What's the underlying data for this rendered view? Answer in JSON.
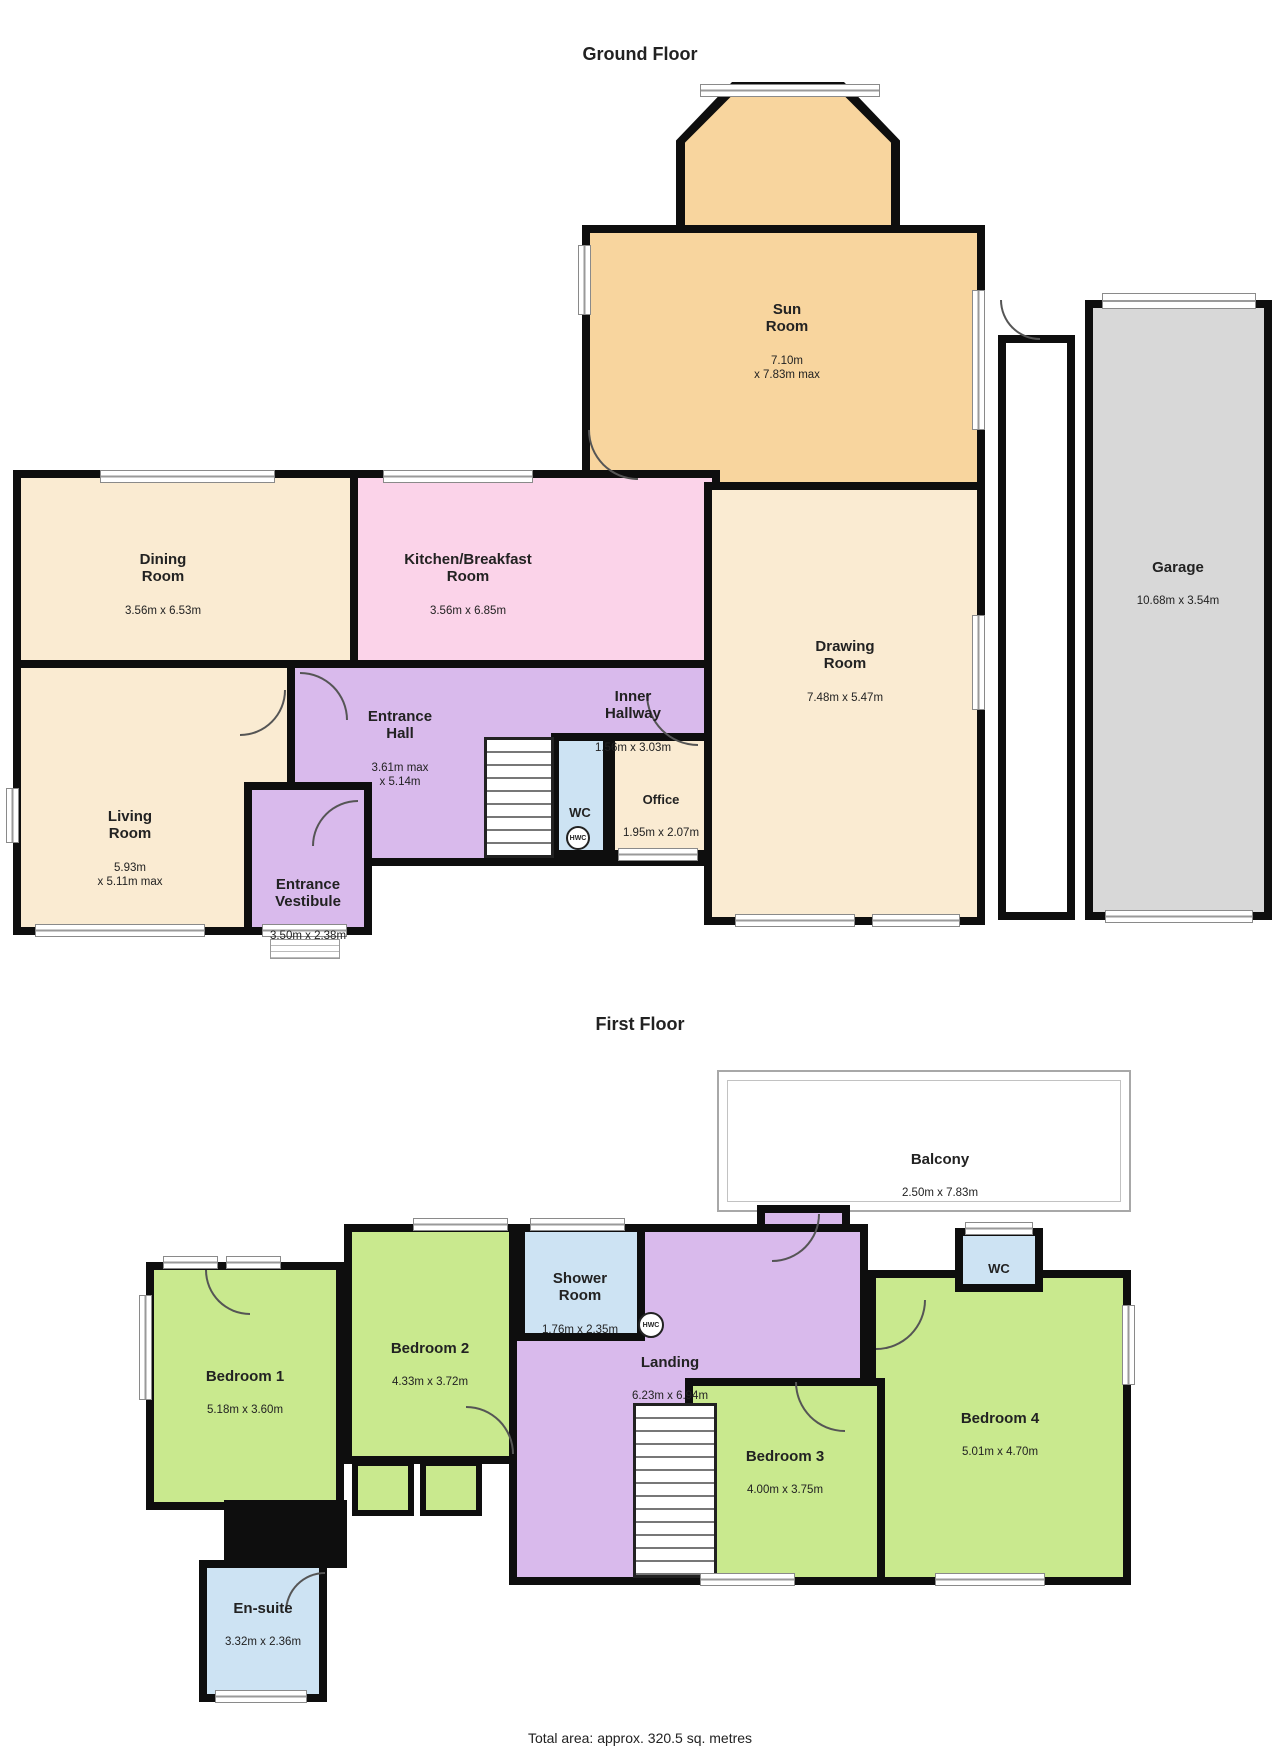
{
  "colors": {
    "cream": "#FAEBD2",
    "orange": "#F8D59E",
    "pink": "#FBD3E9",
    "purple": "#D9BAEC",
    "blue": "#CDE3F3",
    "green": "#C9E98E",
    "gray": "#D8D8D8",
    "wall": "#0E0E0E",
    "white": "#FFFFFF"
  },
  "titles": {
    "ground": "Ground Floor",
    "first": "First Floor"
  },
  "footer": {
    "total_area": "Total area: approx. 320.5 sq. metres"
  },
  "ground": {
    "sun": {
      "name": "Sun\nRoom",
      "dims": "7.10m\nx 7.83m max"
    },
    "dining": {
      "name": "Dining\nRoom",
      "dims": "3.56m x 6.53m"
    },
    "kitchen": {
      "name": "Kitchen/Breakfast\nRoom",
      "dims": "3.56m x 6.85m"
    },
    "drawing": {
      "name": "Drawing\nRoom",
      "dims": "7.48m x 5.47m"
    },
    "living": {
      "name": "Living\nRoom",
      "dims": "5.93m\nx 5.11m max"
    },
    "hall": {
      "name": "Entrance\nHall",
      "dims": "3.61m max\nx 5.14m"
    },
    "inner": {
      "name": "Inner\nHallway",
      "dims": "1.56m x 3.03m"
    },
    "wc": {
      "name": "WC"
    },
    "office": {
      "name": "Office",
      "dims": "1.95m x 2.07m"
    },
    "vestibule": {
      "name": "Entrance\nVestibule",
      "dims": "3.50m x 2.38m"
    },
    "garage": {
      "name": "Garage",
      "dims": "10.68m x 3.54m"
    },
    "hwc": "HWC"
  },
  "first": {
    "balcony": {
      "name": "Balcony",
      "dims": "2.50m x 7.83m"
    },
    "bedroom1": {
      "name": "Bedroom 1",
      "dims": "5.18m x 3.60m"
    },
    "bedroom2": {
      "name": "Bedroom 2",
      "dims": "4.33m x 3.72m"
    },
    "shower": {
      "name": "Shower\nRoom",
      "dims": "1.76m x 2.35m"
    },
    "landing": {
      "name": "Landing",
      "dims": "6.23m x 6.94m"
    },
    "bedroom3": {
      "name": "Bedroom 3",
      "dims": "4.00m x 3.75m"
    },
    "bedroom4": {
      "name": "Bedroom 4",
      "dims": "5.01m x 4.70m"
    },
    "wc": {
      "name": "WC"
    },
    "ensuite": {
      "name": "En-suite",
      "dims": "3.32m x 2.36m"
    },
    "hwc": "HWC"
  }
}
